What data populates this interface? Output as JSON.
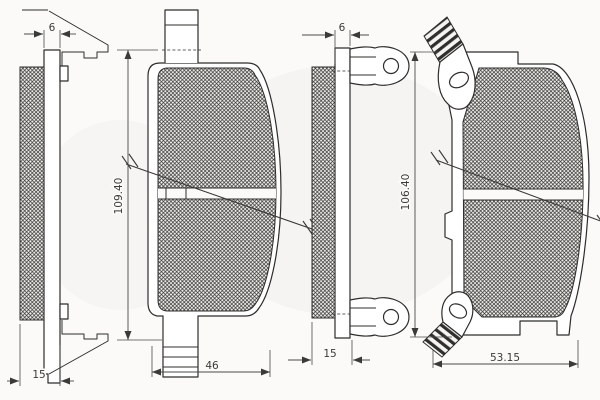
{
  "drawing": {
    "colors": {
      "line": "#2e2d2b",
      "background": "#fbfaf8"
    },
    "left_pad": {
      "side_view": {
        "plate_thickness": "6",
        "total_thickness": "15"
      },
      "front_view": {
        "height": "109.40",
        "width": "46"
      }
    },
    "right_pad": {
      "side_view": {
        "plate_thickness": "6",
        "total_thickness": "15"
      },
      "front_view": {
        "height": "106.40",
        "width": "53.15"
      }
    }
  }
}
